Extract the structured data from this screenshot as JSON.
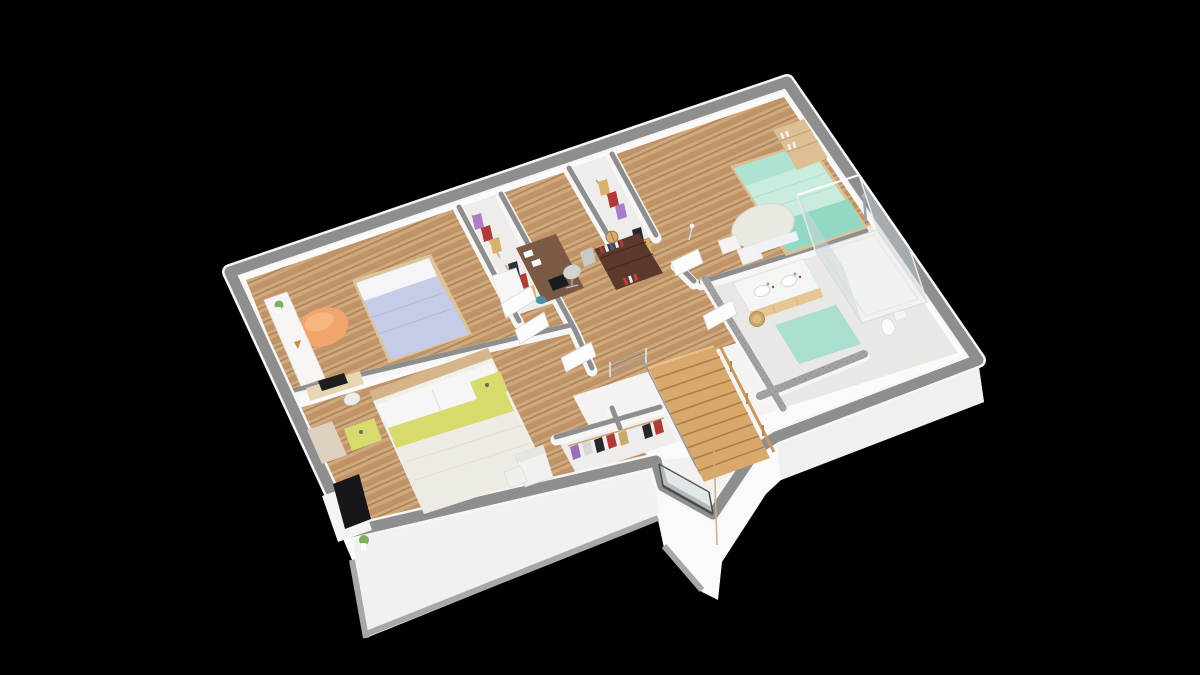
{
  "meta": {
    "view": "3d-isometric-floor-plan-render",
    "canvas": {
      "width": 1200,
      "height": 675
    },
    "floor_shown": "upper-floor"
  },
  "colors": {
    "bg": "#000000",
    "skirt_white": "#fafafa",
    "skirt_shade": "#eeeeee",
    "skirt_edge": "#a8a8a8",
    "wall_gray": "#8e8e8e",
    "wall_face": "#f7f6f5",
    "speckle_base": "#a2a2a2",
    "speckle_dot": "#8a8a8a",
    "wood_light": "#cfa87d",
    "wood_mid": "#c09468",
    "wood_streak": "#ad8257",
    "bath_floor": "#eae8e5",
    "closet_floor": "#efedeb",
    "landing_floor": "#f4f3f2",
    "duvet_lavender": "#c6cbe8",
    "duvet_lavender_fold": "#b4bade",
    "pillow_white": "#f5f5f7",
    "bed_frame_tan": "#dcc49a",
    "beanbag_orange": "#f1a56c",
    "beanbag_highlight": "#f5b67f",
    "shelf_white": "#f6f5f3",
    "plant_green": "#7fae5e",
    "laptop_black": "#1e1e22",
    "desk_pale_wood": "#e6d6b4",
    "headboard_tan": "#d4b488",
    "duvet_cream": "#eeebe4",
    "duvet_cream_fold": "#e2ded6",
    "pillow_yellow": "#d8da6e",
    "nightstand_yellow": "#d9da6c",
    "knob_dark": "#666666",
    "accent_beige": "#ddd0bf",
    "tv_black": "#17171a",
    "media_white": "#f5f4f2",
    "armchair_white": "#f2f1ef",
    "closet_rail_wood": "#c9a670",
    "clothes_purple": "#9b6fb8",
    "clothes_lilac": "#b07cc6",
    "clothes_red": "#b03a3a",
    "clothes_tan": "#d8b06a",
    "clothes_white": "#ededed",
    "clothes_black": "#26262c",
    "clothes_navy": "#2e3240",
    "clothes_gray": "#d8d8d8",
    "hall_desk_brown": "#7a5a45",
    "office_chair_gray": "#d2d2d2",
    "stool_teal": "#4b8fa0",
    "bookshelf_maroon": "#5b3a2b",
    "bookshelf_maroon_dark": "#47291d",
    "book_red": "#b03a3a",
    "book_blue": "#3a5fb0",
    "book_white": "#ededed",
    "globe_tan": "#d9a86b",
    "bed3_pillow_mint": "#aee3d2",
    "bed3_duvet_mint": "#c9ecdc",
    "bed3_blanket_teal": "#93d8c5",
    "bed3_shelf_wood": "#dcc094",
    "table_white": "#ebe7e1",
    "chair_white": "#f4f3f1",
    "vanity_top_white": "#f5f5f4",
    "vanity_wood": "#e6c692",
    "sink_white": "#ffffff",
    "faucet_gray": "#9aa0a6",
    "soap_red": "#c0392b",
    "basket_wicker": "#c9a86a",
    "mat_teal": "#a9ded1",
    "toilet_white": "#fbfbfb",
    "shower_tray": "#f1f1f0",
    "glass_blue": "#ccd6dc",
    "glass_blue2": "#c4cfd7",
    "glass_frame_dark": "#4a4a4a",
    "chrome": "#98a2a8",
    "stair_wood": "#d9a96b",
    "stair_line": "#a97e4f",
    "stair_edge_light": "#e9c289",
    "rail_wood": "#c89a5e",
    "rail_post": "#b68a52",
    "wire_gray": "#9a9a9a",
    "cord_tan": "#c9b089",
    "door_white": "#fcfcfc",
    "door_edge": "#d8d6d3"
  },
  "scene": {
    "building": {
      "style": "cutaway dollhouse view, white slab with gray wall tops",
      "background": "black"
    },
    "rooms": [
      {
        "id": "bedroom-1",
        "name": "Bedroom 1 (top-left)",
        "floor": "wood",
        "furniture": [
          "single bed with lavender duvet",
          "orange bean bag",
          "white wall shelf with plant",
          "desk with black laptop",
          "white chair",
          "walk-in closet with clothes"
        ]
      },
      {
        "id": "master-bedroom",
        "name": "Master bedroom (bottom-left)",
        "floor": "wood",
        "furniture": [
          "double bed with white duvet and yellow pillows",
          "two yellow nightstands",
          "yellow bench",
          "wall TV with white media unit",
          "plant in vase",
          "white armchair with ottoman",
          "walk-in closet with clothes"
        ]
      },
      {
        "id": "landing",
        "name": "Hallway / landing",
        "floor": "wood",
        "furniture": [
          "dark wood desk with laptop and papers",
          "gray office chair",
          "teal stool",
          "dark maroon bookshelf with books",
          "globe"
        ]
      },
      {
        "id": "bedroom-3",
        "name": "Bedroom 3 (top-right)",
        "floor": "wood",
        "furniture": [
          "bed with mint-teal bedding",
          "light wood bookcase",
          "round white table",
          "white chairs",
          "floor lamp"
        ]
      },
      {
        "id": "bathroom",
        "name": "Bathroom (right)",
        "floor": "light tile",
        "furniture": [
          "double-sink wood vanity",
          "wicker laundry basket",
          "teal bath mat",
          "glass corner shower",
          "toilet",
          "speckled gray half walls"
        ]
      },
      {
        "id": "stairwell",
        "name": "Stairwell / bay",
        "floor": "white landing",
        "furniture": [
          "wooden staircase",
          "wood handrail",
          "wire balustrade",
          "dark framed glass panel",
          "hanging pendant cord"
        ]
      }
    ]
  }
}
